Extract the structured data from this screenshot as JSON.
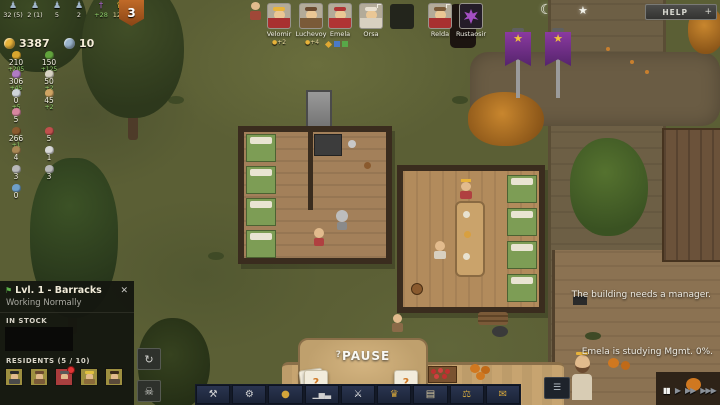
{
  "colors": {
    "gold": "#e8b33a",
    "silver": "#9ab4cc",
    "banner_purple": "#7a2f96",
    "alert_red": "#c03636",
    "panel_bg": "#15170f"
  },
  "hud": {
    "stats": [
      {
        "icon": "peasants-icon",
        "glyph": "♟",
        "value": "32 (5)"
      },
      {
        "icon": "nobles-icon",
        "glyph": "♟",
        "value": "2 (1)"
      },
      {
        "icon": "warriors-icon",
        "glyph": "♟",
        "value": "5"
      },
      {
        "icon": "prisoners-icon",
        "glyph": "♟",
        "value": "2"
      },
      {
        "icon": "faith-icon",
        "glyph": "†",
        "value": "+28"
      },
      {
        "icon": "authority-icon",
        "glyph": "♛",
        "value": "12%"
      }
    ],
    "threat_badge": "3",
    "gold": "3387",
    "silver": "10",
    "resources": [
      {
        "name": "grain",
        "value": "210",
        "delta": "+205"
      },
      {
        "name": "herbs",
        "value": "150",
        "delta": "+125"
      },
      {
        "name": "berries",
        "value": "306",
        "delta": "+45"
      },
      {
        "name": "flour",
        "value": "50",
        "delta": "+2"
      },
      {
        "name": "eggs",
        "value": "0",
        "delta": "+5"
      },
      {
        "name": "bread",
        "value": "45",
        "delta": "+2"
      },
      {
        "name": "meat",
        "value": "5",
        "delta": ""
      },
      {
        "name": "ale",
        "value": "266",
        "delta": "+1"
      },
      {
        "name": "ham",
        "value": "5",
        "delta": ""
      },
      {
        "name": "sacks",
        "value": "4",
        "delta": ""
      },
      {
        "name": "bones",
        "value": "1",
        "delta": ""
      },
      {
        "name": "axes",
        "value": "3",
        "delta": ""
      },
      {
        "name": "hammers",
        "value": "3",
        "delta": ""
      },
      {
        "name": "fish",
        "value": "0",
        "delta": ""
      }
    ],
    "portraits": [
      {
        "name": "Velomir",
        "buff": "+2"
      },
      {
        "name": "Luchevoy",
        "buff": "+4"
      },
      {
        "name": "Emela",
        "buff": ""
      },
      {
        "name": "Orsa",
        "buff": ""
      },
      {
        "name": "Relda",
        "buff": ""
      },
      {
        "name": "Rustaosir",
        "buff": ""
      }
    ],
    "help_label": "HELP",
    "help_plus": "+"
  },
  "sky": {
    "moon": "☾",
    "star": "★"
  },
  "panel": {
    "title": "Lvl. 1 - Barracks",
    "status": "Working Normally",
    "in_stock_label": "IN STOCK",
    "residents_label": "RESIDENTS (5 / 10)",
    "close": "✕",
    "flag_icon": "⚑",
    "rotate_icon": "↻",
    "skull_icon": "☠"
  },
  "world": {
    "pause_label": "PAUSE",
    "pause_curl": "?",
    "messages": {
      "manager": "The building needs a manager.",
      "study": "Emela is studying Mgmt. 0%."
    }
  },
  "toolbar": {
    "items": [
      {
        "name": "build",
        "icon": "hammer-icon",
        "glyph": "⚒"
      },
      {
        "name": "production",
        "icon": "gear-icon",
        "glyph": "⚙"
      },
      {
        "name": "economy",
        "icon": "money-bag-icon",
        "glyph": "●"
      },
      {
        "name": "statistics",
        "icon": "chart-icon",
        "glyph": "▁▅▃"
      },
      {
        "name": "military",
        "icon": "swords-icon",
        "glyph": "⚔"
      },
      {
        "name": "nobility",
        "icon": "crown-icon",
        "glyph": "♛"
      },
      {
        "name": "knowledge",
        "icon": "book-icon",
        "glyph": "▤"
      },
      {
        "name": "laws",
        "icon": "scales-icon",
        "glyph": "⚖"
      },
      {
        "name": "letters",
        "icon": "letter-icon",
        "glyph": "✉"
      }
    ],
    "cards": [
      {
        "label": "?"
      },
      {
        "label": "?"
      }
    ],
    "list_button": "☰"
  },
  "speed": {
    "pause": "▮▮",
    "play": "▶",
    "fast": "▶▶",
    "fastest": "▶▶▶"
  }
}
